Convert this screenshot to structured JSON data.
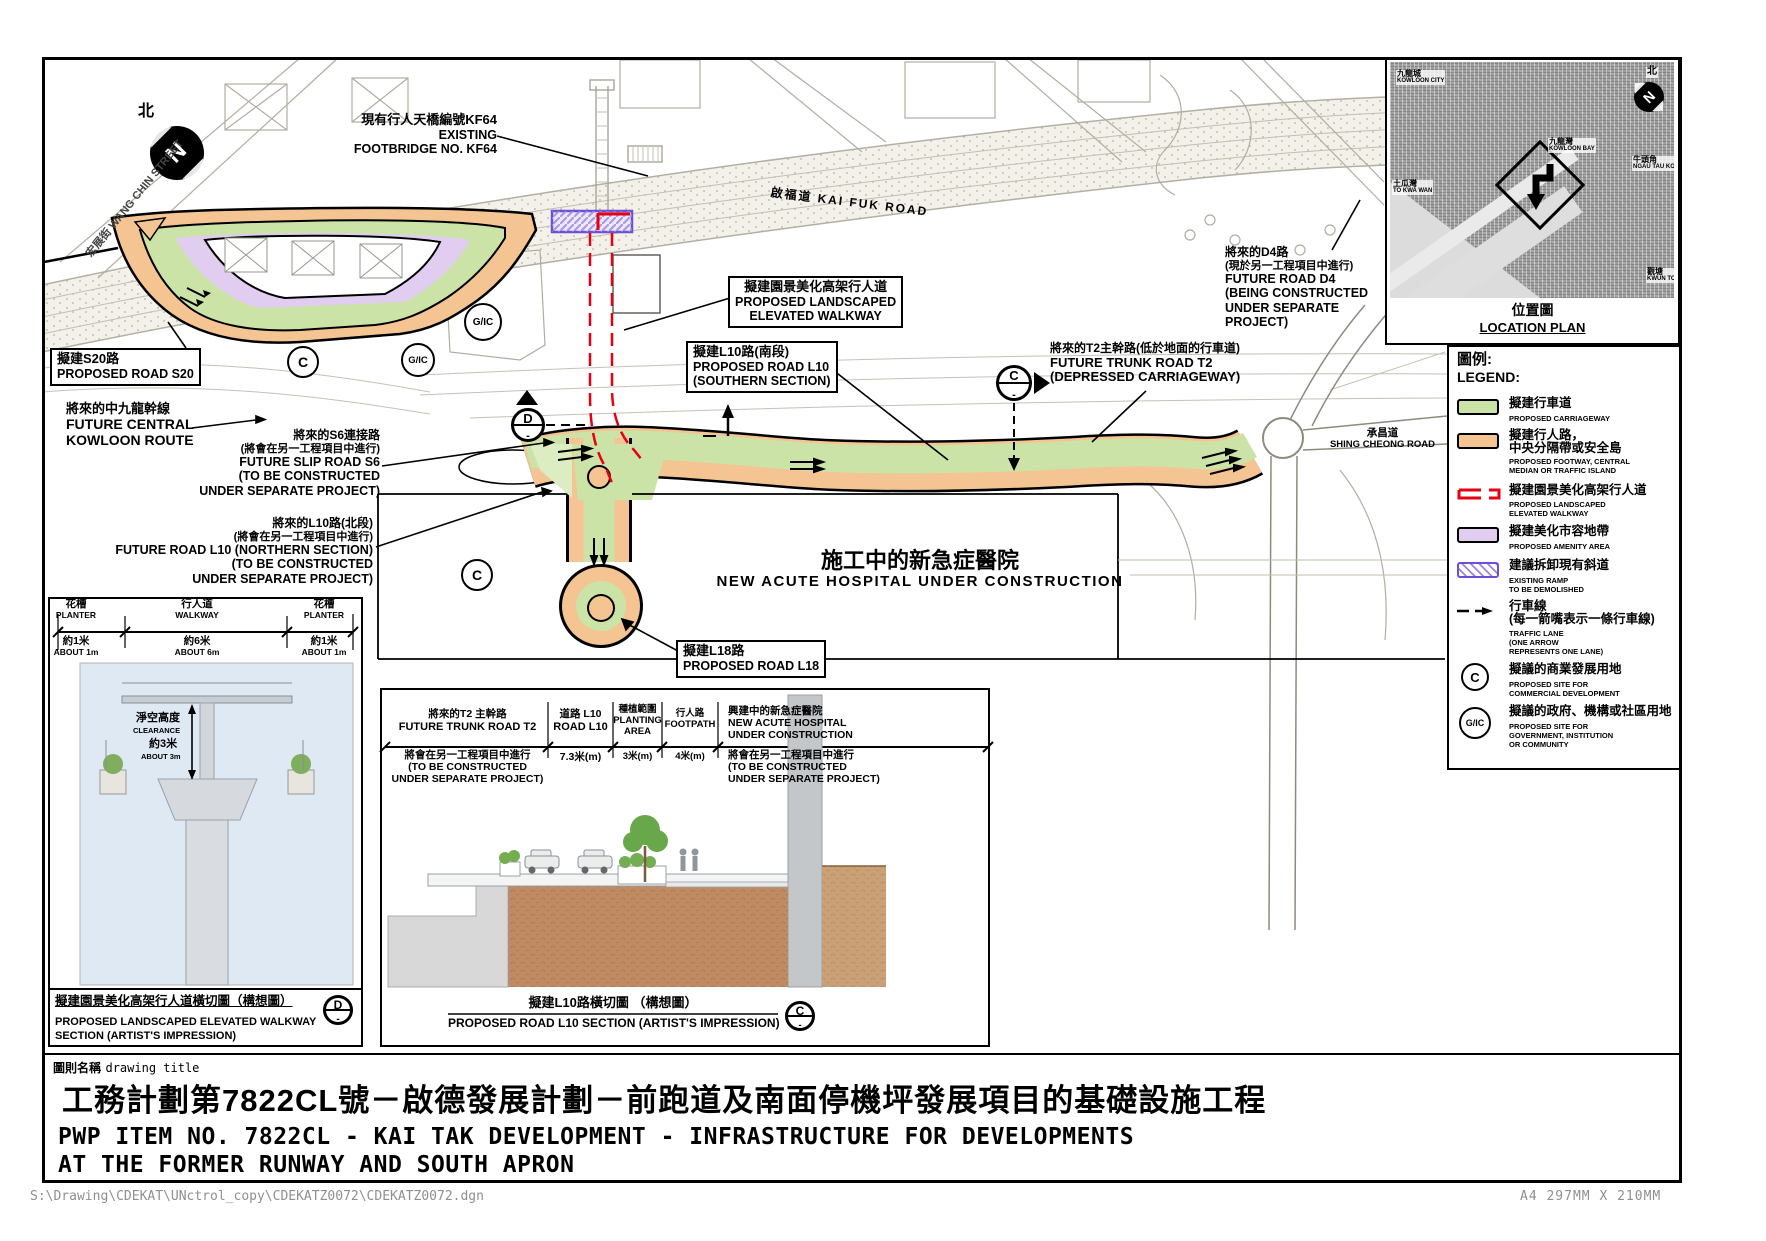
{
  "plan": {
    "north_label": "北",
    "street": {
      "zh": "宏展街",
      "en": "WANG CHIN STREET"
    },
    "kai_fuk_road": {
      "zh": "啟福道",
      "en": "KAI FUK ROAD"
    },
    "footbridge": {
      "zh": "現有行人天橋編號KF64",
      "en1": "EXISTING",
      "en2": "FOOTBRIDGE NO. KF64"
    },
    "road_s20": {
      "zh": "擬建S20路",
      "en": "PROPOSED ROAD S20"
    },
    "central_kowloon_route": {
      "zh": "將來的中九龍幹線",
      "en1": "FUTURE CENTRAL",
      "en2": "KOWLOON ROUTE"
    },
    "slip_road_s6": {
      "zh1": "將來的S6連接路",
      "zh2": "(將會在另一工程項目中進行)",
      "en1": "FUTURE SLIP ROAD S6",
      "en2": "(TO BE CONSTRUCTED",
      "en3": "UNDER SEPARATE PROJECT)"
    },
    "road_l10_north": {
      "zh1": "將來的L10路(北段)",
      "zh2": "(將會在另一工程項目中進行)",
      "en1": "FUTURE ROAD L10 (NORTHERN SECTION)",
      "en2": "(TO BE CONSTRUCTED",
      "en3": "UNDER SEPARATE PROJECT)"
    },
    "landscaped_walkway": {
      "zh": "擬建園景美化高架行人道",
      "en1": "PROPOSED LANDSCAPED",
      "en2": "ELEVATED WALKWAY"
    },
    "road_l10_south": {
      "zh": "擬建L10路(南段)",
      "en1": "PROPOSED ROAD L10",
      "en2": "(SOUTHERN SECTION)"
    },
    "trunk_road_t2": {
      "zh": "將來的T2主幹路(低於地面的行車道)",
      "en1": "FUTURE TRUNK ROAD T2",
      "en2": "(DEPRESSED CARRIAGEWAY)"
    },
    "road_d4": {
      "zh1": "將來的D4路",
      "zh2": "(現於另一工程項目中進行)",
      "en1": "FUTURE ROAD D4",
      "en2": "(BEING CONSTRUCTED",
      "en3": "UNDER SEPARATE",
      "en4": "PROJECT)"
    },
    "hospital": {
      "zh": "施工中的新急症醫院",
      "en": "NEW ACUTE HOSPITAL UNDER CONSTRUCTION"
    },
    "road_l18": {
      "zh": "擬建L18路",
      "en": "PROPOSED ROAD L18"
    },
    "shing_cheong_road": {
      "zh": "承昌道",
      "en": "SHING CHEONG ROAD"
    },
    "markers": {
      "commercial": "C",
      "gic": "G/IC",
      "section_d": "D",
      "section_c": "C",
      "dash": "-"
    }
  },
  "legend": {
    "title_zh": "圖例:",
    "title_en": "LEGEND:",
    "items": [
      {
        "zh": "擬建行車道",
        "en1": "PROPOSED CARRIAGEWAY"
      },
      {
        "zh1": "擬建行人路，",
        "zh2": "中央分隔帶或安全島",
        "en1": "PROPOSED FOOTWAY, CENTRAL",
        "en2": "MEDIAN OR TRAFFIC ISLAND"
      },
      {
        "zh": "擬建園景美化高架行人道",
        "en1": "PROPOSED LANDSCAPED",
        "en2": "ELEVATED WALKWAY"
      },
      {
        "zh": "擬建美化市容地帶",
        "en1": "PROPOSED AMENITY AREA"
      },
      {
        "zh": "建議拆卸現有斜道",
        "en1": "EXISTING RAMP",
        "en2": "TO BE DEMOLISHED"
      },
      {
        "zh1": "行車線",
        "zh2": "(每一箭嘴表示一條行車線)",
        "en1": "TRAFFIC LANE",
        "en2": "(ONE ARROW",
        "en3": "REPRESENTS ONE LANE)"
      },
      {
        "symbol": "C",
        "zh": "擬議的商業發展用地",
        "en1": "PROPOSED SITE FOR",
        "en2": "COMMERCIAL DEVELOPMENT"
      },
      {
        "symbol": "G/IC",
        "zh": "擬議的政府、機構或社區用地",
        "en1": "PROPOSED SITE FOR",
        "en2": "GOVERNMENT, INSTITUTION",
        "en3": "OR COMMUNITY"
      }
    ]
  },
  "location_plan": {
    "caption_zh": "位置圖",
    "caption_en": "LOCATION PLAN",
    "north": "北",
    "labels": [
      {
        "zh": "九龍城",
        "en": "KOWLOON CITY"
      },
      {
        "zh": "九龍灣",
        "en": "KOWLOON BAY"
      },
      {
        "zh": "土瓜灣",
        "en": "TO KWA WAN"
      },
      {
        "zh": "牛頭角",
        "en": "NGAU TAU KOK"
      },
      {
        "zh": "觀塘",
        "en": "KWUN TONG"
      }
    ]
  },
  "walkway_section": {
    "planter_zh": "花槽",
    "planter_en": "PLANTER",
    "planter_dim_zh": "約1米",
    "planter_dim_en": "ABOUT 1m",
    "walkway_zh": "行人道",
    "walkway_en": "WALKWAY",
    "walkway_dim_zh": "約6米",
    "walkway_dim_en": "ABOUT 6m",
    "clearance_zh": "淨空高度",
    "clearance_en": "CLEARANCE",
    "clearance_dim_zh": "約3米",
    "clearance_dim_en": "ABOUT 3m",
    "caption_zh": "擬建園景美化高架行人道橫切圖（構想圖）",
    "caption_en1": "PROPOSED LANDSCAPED ELEVATED WALKWAY",
    "caption_en2": "SECTION (ARTIST'S IMPRESSION)",
    "marker": "D",
    "marker_dash": "-"
  },
  "road_section": {
    "col_t2": {
      "zh": "將來的T2 主幹路",
      "en": "FUTURE TRUNK ROAD T2",
      "note_zh": "將會在另一工程項目中進行",
      "note_en1": "(TO BE CONSTRUCTED",
      "note_en2": "UNDER SEPARATE PROJECT)"
    },
    "col_l10": {
      "zh": "道路 L10",
      "en": "ROAD L10",
      "dim": "7.3米(m)"
    },
    "col_planting": {
      "zh": "種植範圍",
      "en1": "PLANTING",
      "en2": "AREA",
      "dim": "3米(m)"
    },
    "col_footpath": {
      "zh": "行人路",
      "en": "FOOTPATH",
      "dim": "4米(m)"
    },
    "col_hospital": {
      "zh": "興建中的新急症醫院",
      "en1": "NEW ACUTE HOSPITAL",
      "en2": "UNDER CONSTRUCTION",
      "note_zh": "將會在另一工程項目中進行",
      "note_en1": "(TO BE CONSTRUCTED",
      "note_en2": "UNDER SEPARATE PROJECT)"
    },
    "caption_zh": "擬建L10路橫切圖 （構想圖）",
    "caption_en": "PROPOSED ROAD L10 SECTION (ARTIST'S IMPRESSION)",
    "marker": "C",
    "marker_dash": "-"
  },
  "title_block": {
    "label_zh": "圖則名稱",
    "label_en": "drawing title",
    "title_zh": "工務計劃第7822CL號－啟德發展計劃－前跑道及南面停機坪發展項目的基礎設施工程",
    "title_en1": "PWP ITEM NO. 7822CL - KAI TAK DEVELOPMENT - INFRASTRUCTURE FOR DEVELOPMENTS",
    "title_en2": "AT THE FORMER RUNWAY AND SOUTH APRON"
  },
  "status_bar": {
    "file_path": "S:\\Drawing\\CDEKAT\\UNctrol_copy\\CDEKATZ0072\\CDEKATZ0072.dgn",
    "paper_size": "A4 297MM X 210MM"
  },
  "colors": {
    "carriageway": "#cbe3a6",
    "footway": "#f5c493",
    "amenity": "#e0cdf0",
    "walkway_red": "#e60012",
    "ramp_purple": "#6b4fd4"
  }
}
